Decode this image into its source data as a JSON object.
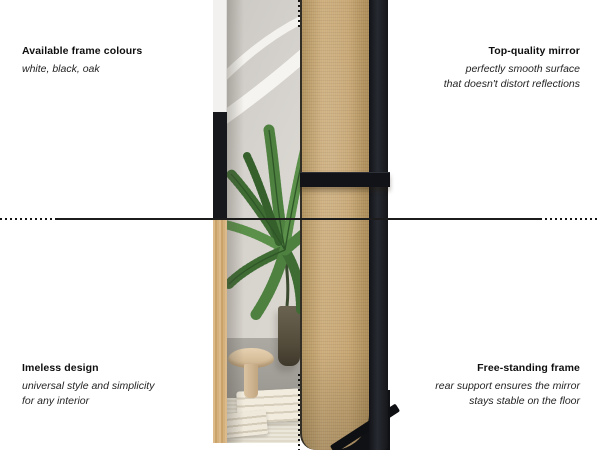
{
  "annotations": {
    "top_left": {
      "title": "Available frame colours",
      "lines": [
        "white, black, oak"
      ]
    },
    "top_right": {
      "title": "Top-quality mirror",
      "lines": [
        "perfectly smooth surface",
        "that doesn't distort reflections"
      ]
    },
    "bottom_left": {
      "title": "Imeless design",
      "lines": [
        "universal style and simplicity",
        "for any interior"
      ]
    },
    "bottom_right": {
      "title": "Free-standing frame",
      "lines": [
        "rear support ensures the mirror",
        "stays stable on the floor"
      ]
    }
  },
  "colors": {
    "background": "#ffffff",
    "text": "#0e0e0e",
    "guide_line": "#1c1c1c",
    "frame_white": "#f2f1ef",
    "frame_black": "#17181c",
    "frame_oak": "#d3ab76",
    "mirror_back_board": "#c6a571",
    "plant_green": "#4e8040"
  }
}
